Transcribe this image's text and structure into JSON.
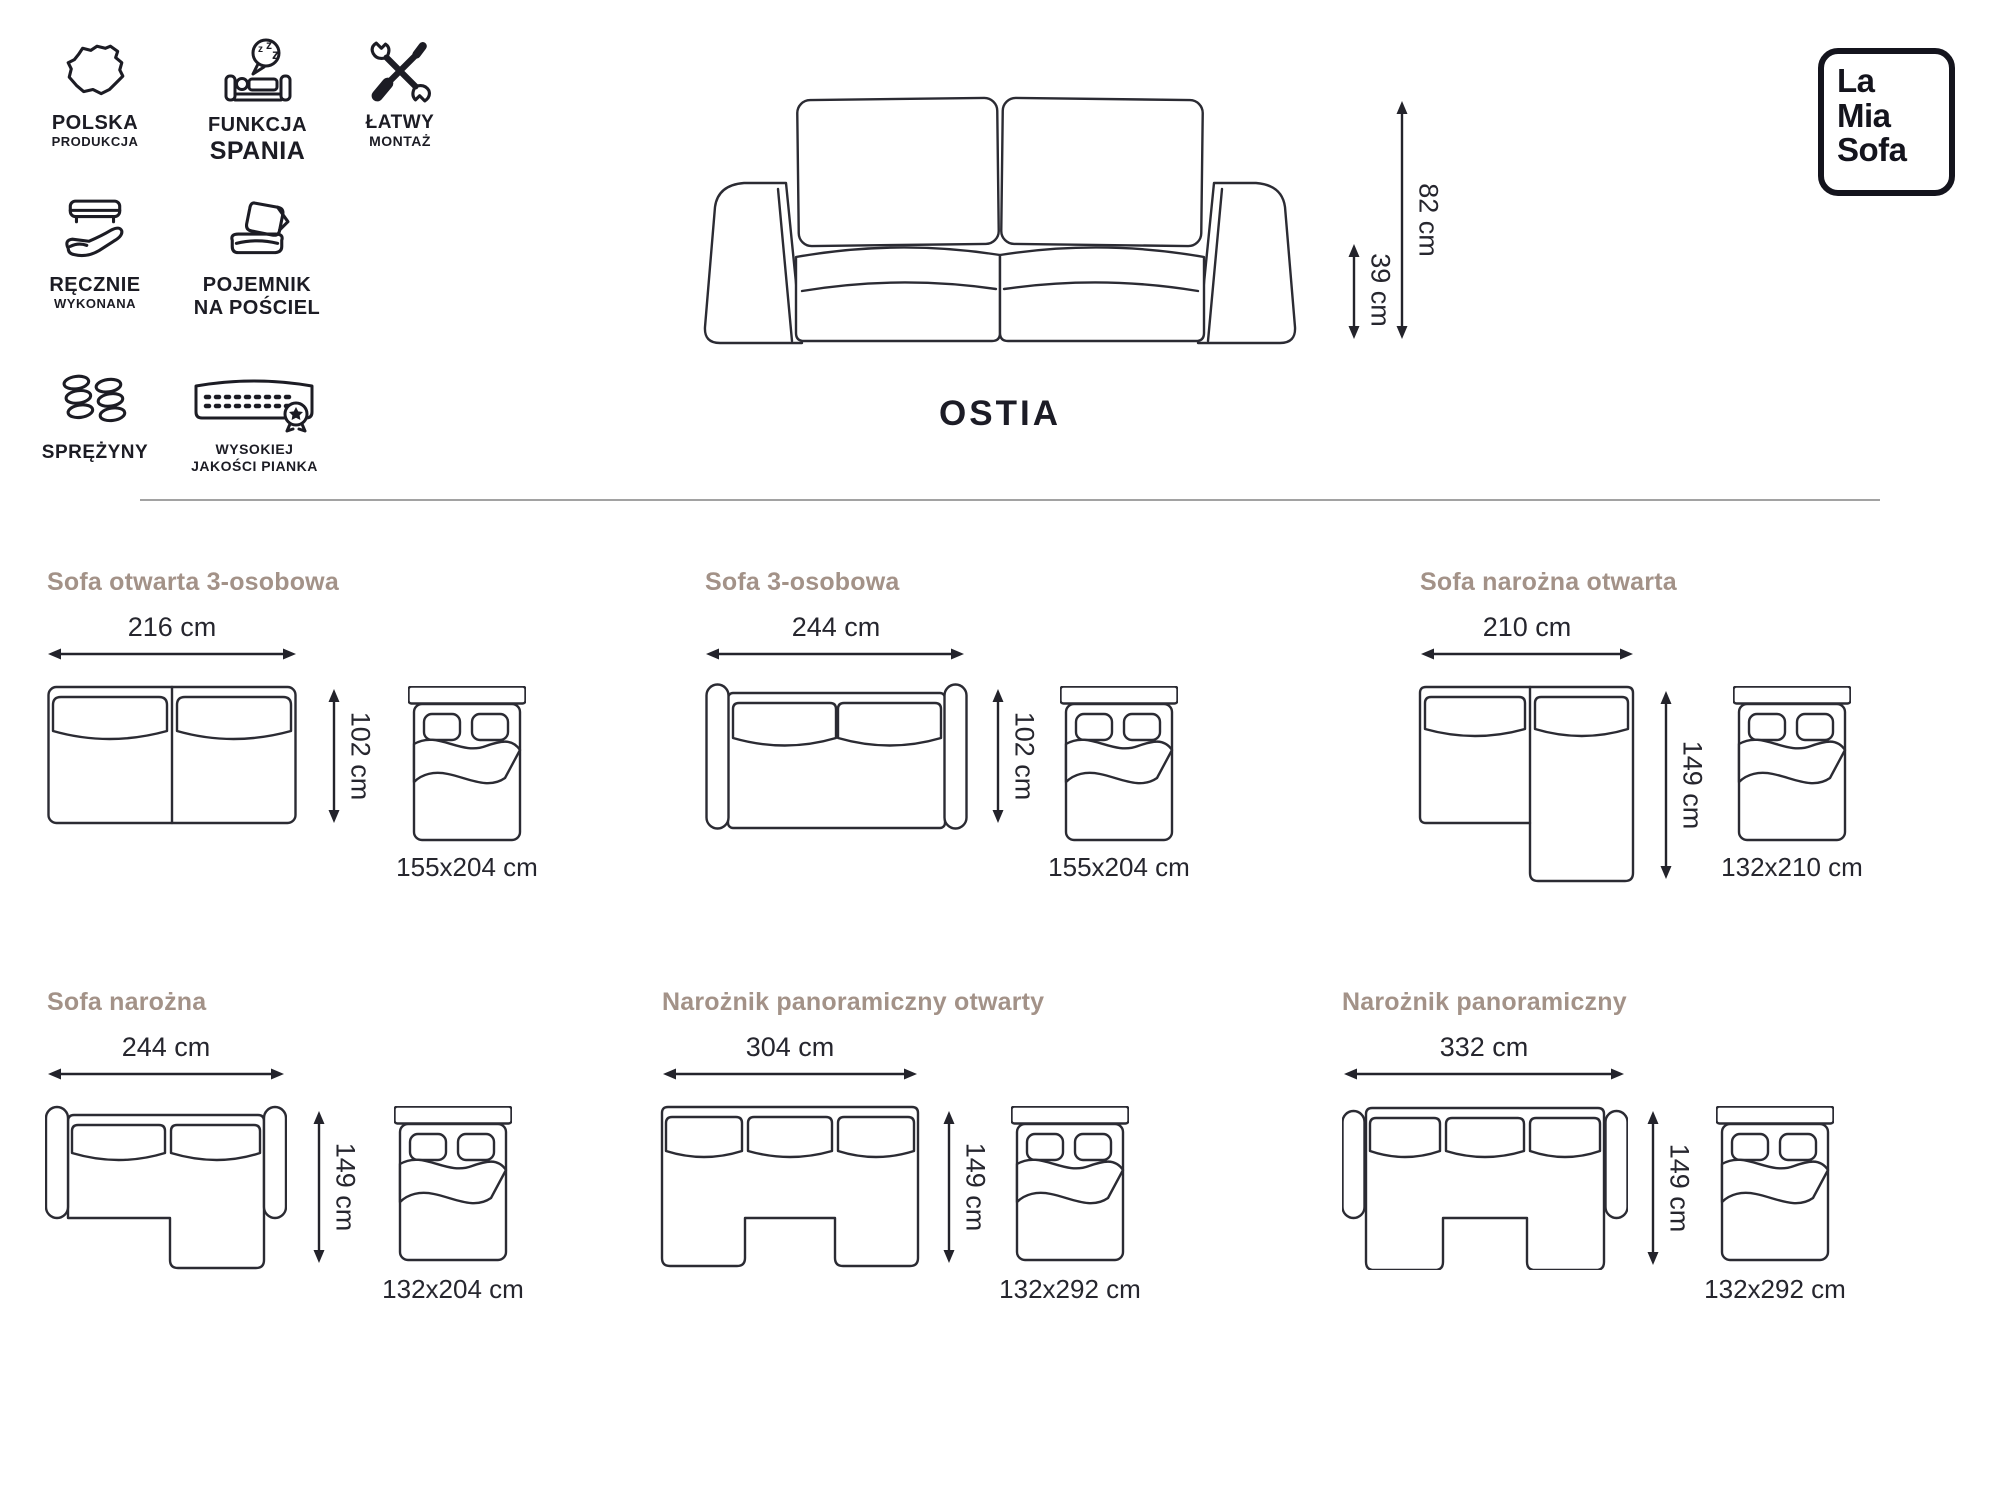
{
  "brand": {
    "line1": "La",
    "line2": "Mia",
    "line3": "Sofa"
  },
  "product_title": "OSTIA",
  "features": [
    {
      "id": "poland",
      "line1": "POLSKA",
      "line2": "PRODUKCJA"
    },
    {
      "id": "sleep-function",
      "line1": "FUNKCJA",
      "line2": "SPANIA"
    },
    {
      "id": "easy-assembly",
      "line1": "ŁATWY",
      "line2": "MONTAŻ"
    },
    {
      "id": "handmade",
      "line1": "RĘCZNIE",
      "line2": "WYKONANA"
    },
    {
      "id": "bedding-container",
      "line1": "POJEMNIK",
      "line2": "NA POŚCIEL"
    },
    {
      "id": "springs",
      "line1": "SPRĘŻYNY",
      "line2": ""
    },
    {
      "id": "quality-foam",
      "line1": "WYSOKIEJ",
      "line2": "JAKOŚCI PIANKA"
    }
  ],
  "front_view": {
    "height_label": "82 cm",
    "seat_height_label": "39 cm"
  },
  "sections": [
    {
      "title": "Sofa otwarta 3-osobowa",
      "width": "216 cm",
      "depth": "102 cm",
      "bed": "155x204 cm",
      "type": "open"
    },
    {
      "title": "Sofa 3-osobowa",
      "width": "244 cm",
      "depth": "102 cm",
      "bed": "155x204 cm",
      "type": "arms"
    },
    {
      "title": "Sofa narożna otwarta",
      "width": "210 cm",
      "depth": "149 cm",
      "bed": "132x210 cm",
      "type": "corner-open"
    },
    {
      "title": "Sofa narożna",
      "width": "244 cm",
      "depth": "149 cm",
      "bed": "132x204 cm",
      "type": "corner-arms"
    },
    {
      "title": "Narożnik panoramiczny otwarty",
      "width": "304 cm",
      "depth": "149 cm",
      "bed": "132x292 cm",
      "type": "panoramic-open"
    },
    {
      "title": "Narożnik panoramiczny",
      "width": "332 cm",
      "depth": "149 cm",
      "bed": "132x292 cm",
      "type": "panoramic-arms"
    }
  ],
  "colors": {
    "heading": "#a39288",
    "ink": "#26262e",
    "linework": "#2b2b33",
    "divider": "#a2a2a2"
  }
}
